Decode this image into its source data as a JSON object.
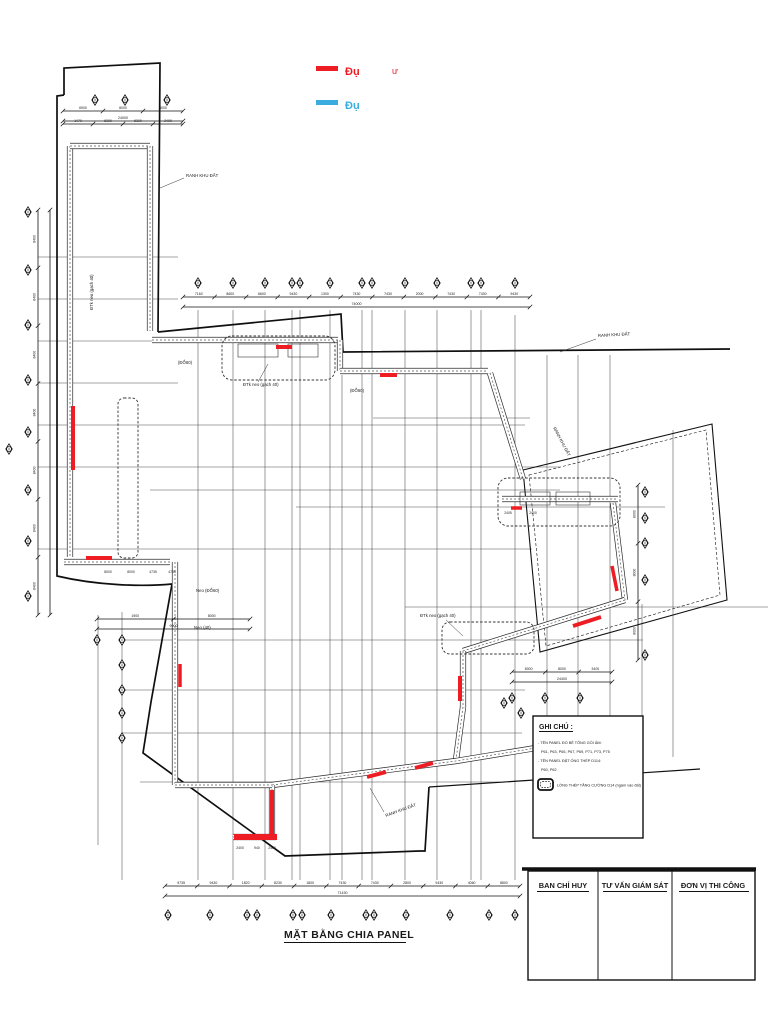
{
  "meta": {
    "ink": "#1a1a1a",
    "red": "#ee1c23",
    "blue": "#3aace0",
    "paper": "#ffffff"
  },
  "legend": {
    "items": [
      {
        "swatch": "red",
        "label": "Đụ",
        "suffix": "ư",
        "color": "#ee1c23"
      },
      {
        "swatch": "blue",
        "label": "Đụ",
        "suffix": "",
        "color": "#3aace0"
      }
    ]
  },
  "drawing_title": "MẶT BẰNG CHIA PANEL",
  "notes": {
    "heading": "GHI CHÚ :",
    "lines": [
      "- TÊN PANEL ĐỔ BÊ TÔNG GỐI ÂM:",
      "P61, P63, P65, P67, P69, P71, P73, P75",
      "- TÊN PANEL ĐẶT ỐNG THÉP D114:",
      "P60, P62"
    ],
    "icon_label": "LỒNG THÉP TĂNG CƯỜNG D14 (ngàm vào đất)"
  },
  "signoff": {
    "columns": [
      "BAN CHỈ HUY",
      "TƯ VẤN GIÁM SÁT",
      "ĐƠN VỊ THI CÔNG"
    ]
  },
  "plan_labels": [
    {
      "text": "RANH KHU ĐẤT",
      "x": 186,
      "y": 177,
      "rot": 0,
      "leader": [
        184,
        178,
        160,
        188
      ]
    },
    {
      "text": "RANH KHU ĐẤT",
      "x": 598,
      "y": 337,
      "rot": -3,
      "leader": [
        596,
        339,
        560,
        352
      ]
    },
    {
      "text": "RANH KHU ĐẤT",
      "x": 553,
      "y": 428,
      "rot": 62
    },
    {
      "text": "RANH KHU ĐẤT",
      "x": 386,
      "y": 817,
      "rot": -20,
      "leader": [
        384,
        812,
        370,
        788
      ]
    },
    {
      "text": "ĐTk neo (gạch 40)",
      "x": 93,
      "y": 310,
      "rot": -90
    },
    {
      "text": "ĐTk neo (gạch 40)",
      "x": 243,
      "y": 386,
      "rot": 0,
      "leader": [
        258,
        382,
        268,
        364
      ]
    },
    {
      "text": "ĐTk neo (gạch 40)",
      "x": 420,
      "y": 617,
      "rot": 0,
      "leader": [
        446,
        620,
        463,
        636
      ]
    },
    {
      "text": "Neo (ĐỔ60)",
      "x": 196,
      "y": 592,
      "rot": 0
    },
    {
      "text": "Neo (40)",
      "x": 194,
      "y": 629,
      "rot": 0
    },
    {
      "text": "(ĐỔ60)",
      "x": 178,
      "y": 364,
      "rot": 0
    },
    {
      "text": "(ĐỔ60)",
      "x": 350,
      "y": 392,
      "rot": 0
    }
  ],
  "strip_dims": [
    {
      "t": "8000",
      "x": 108,
      "y": 573
    },
    {
      "t": "8000",
      "x": 131,
      "y": 573
    },
    {
      "t": "4735",
      "x": 153,
      "y": 573
    },
    {
      "t": "4735",
      "x": 172,
      "y": 573
    },
    {
      "t": "2400",
      "x": 240,
      "y": 849
    },
    {
      "t": "940",
      "x": 257,
      "y": 849
    },
    {
      "t": "2400",
      "x": 272,
      "y": 849
    },
    {
      "t": "2405",
      "x": 508,
      "y": 514
    },
    {
      "t": "2400",
      "x": 533,
      "y": 514
    }
  ],
  "dimensions": [
    {
      "id": "dim-top",
      "o": "h",
      "x1": 183,
      "x2": 530,
      "y": 297,
      "values": [
        "7160",
        "8600",
        "6600",
        "9430",
        "1300",
        "7430",
        "7430",
        "2000",
        "7430",
        "7430",
        "9430"
      ],
      "total": "74000"
    },
    {
      "id": "dim-topleft-1",
      "o": "h",
      "x1": 63,
      "x2": 183,
      "y": 111,
      "values": [
        "6900",
        "8000",
        "8000"
      ],
      "total": "24000"
    },
    {
      "id": "dim-topleft-2",
      "o": "h",
      "x1": 63,
      "x2": 183,
      "y": 124,
      "values": [
        "1470",
        "6300",
        "6300",
        "2400"
      ]
    },
    {
      "id": "dim-left",
      "o": "v",
      "x": 38,
      "y1": 210,
      "y2": 615,
      "values": [
        "8400",
        "8400",
        "8400",
        "8400",
        "8400",
        "8400",
        "8400"
      ]
    },
    {
      "id": "dim-left-2",
      "o": "v",
      "x": 50,
      "y1": 210,
      "y2": 615,
      "values": []
    },
    {
      "id": "dim-bottom",
      "o": "h",
      "x1": 165,
      "x2": 520,
      "y": 886,
      "values": [
        "9735",
        "9430",
        "1820",
        "8230",
        "1800",
        "7430",
        "7430",
        "2800",
        "9430",
        "4060",
        "8800"
      ],
      "total": "71430"
    },
    {
      "id": "dim-bottom-left",
      "o": "h",
      "x1": 97,
      "x2": 250,
      "y": 619,
      "values": [
        "1900",
        "8000"
      ],
      "total": "9900"
    },
    {
      "id": "dim-right-bottom",
      "o": "h",
      "x1": 512,
      "x2": 612,
      "y": 672,
      "values": [
        "8000",
        "8000",
        "3400"
      ],
      "total": "24400"
    },
    {
      "id": "dim-right",
      "o": "v",
      "x": 638,
      "y1": 485,
      "y2": 660,
      "values": [
        "8000",
        "8000",
        "8000"
      ]
    }
  ],
  "highlights": [
    {
      "x1": 73,
      "y1": 406,
      "x2": 73,
      "y2": 470,
      "w": 4
    },
    {
      "x1": 276,
      "y1": 347,
      "x2": 292,
      "y2": 347,
      "w": 4
    },
    {
      "x1": 380,
      "y1": 375,
      "x2": 397,
      "y2": 375,
      "w": 4
    },
    {
      "x1": 86,
      "y1": 558,
      "x2": 112,
      "y2": 558,
      "w": 4
    },
    {
      "x1": 180,
      "y1": 664,
      "x2": 180,
      "y2": 687,
      "w": 3.5
    },
    {
      "x1": 511,
      "y1": 508,
      "x2": 522,
      "y2": 508,
      "w": 3.5
    },
    {
      "x1": 460,
      "y1": 676,
      "x2": 460,
      "y2": 701,
      "w": 4
    },
    {
      "x1": 612,
      "y1": 566,
      "x2": 617,
      "y2": 591,
      "w": 3.5
    },
    {
      "x1": 573,
      "y1": 626,
      "x2": 601,
      "y2": 617,
      "w": 4
    },
    {
      "x1": 272,
      "y1": 790,
      "x2": 272,
      "y2": 835,
      "w": 4
    },
    {
      "x1": 234,
      "y1": 837,
      "x2": 277,
      "y2": 837,
      "w": 6
    },
    {
      "x1": 367,
      "y1": 777,
      "x2": 386,
      "y2": 772,
      "w": 4
    },
    {
      "x1": 415,
      "y1": 768,
      "x2": 433,
      "y2": 763,
      "w": 4
    }
  ]
}
